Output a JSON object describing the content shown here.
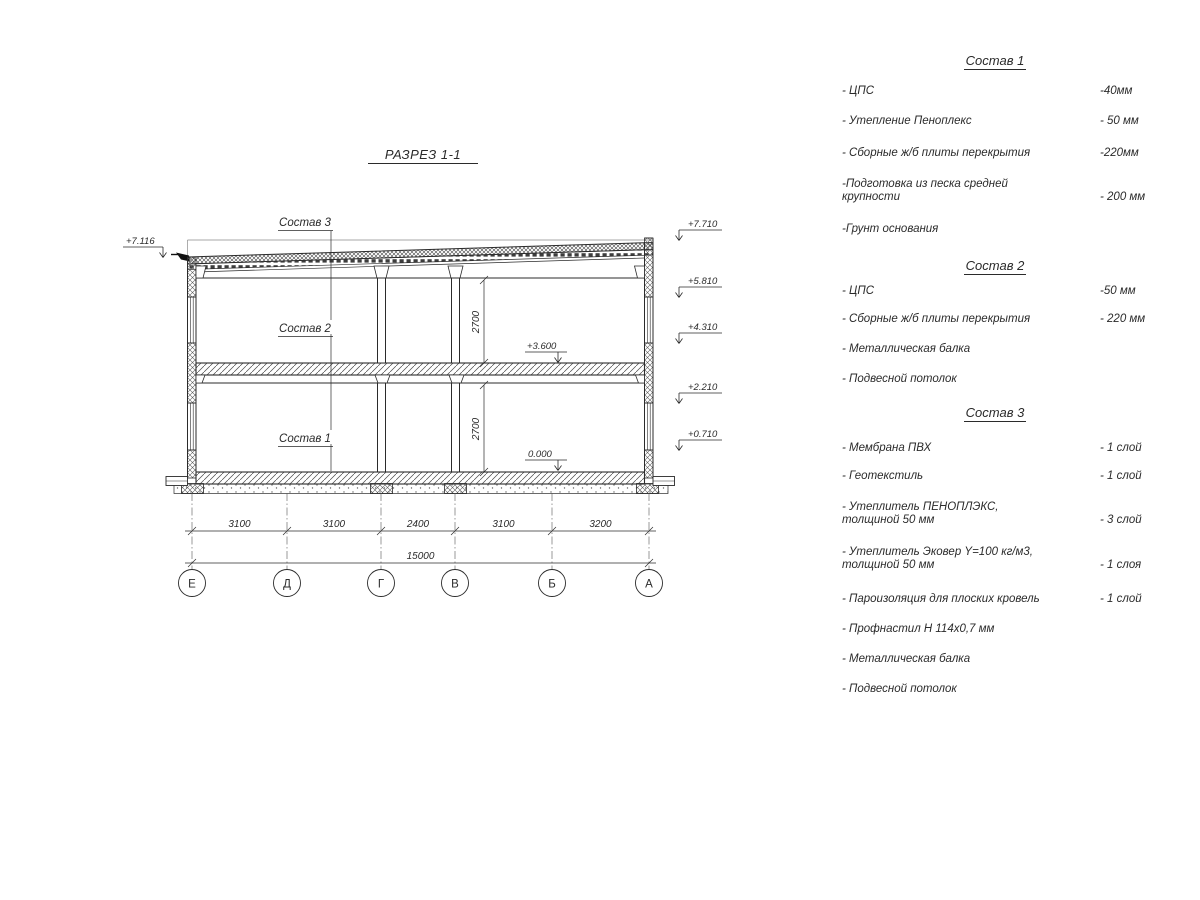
{
  "page": {
    "title": "РАЗРЕЗ 1-1"
  },
  "section_labels": {
    "s3": "Состав 3",
    "s2": "Состав 2",
    "s1": "Состав 1"
  },
  "elevations": {
    "left_top": "+7.116",
    "r1": "+7.710",
    "r2": "+5.810",
    "r3": "+4.310",
    "r4": "+2.210",
    "r5": "+0.710",
    "floor2": "+3.600",
    "floor0": "0.000"
  },
  "dimensions": {
    "d1": "3100",
    "d2": "3100",
    "d3": "2400",
    "d4": "3100",
    "d5": "3200",
    "total": "15000",
    "h_upper": "2700",
    "h_lower": "2700"
  },
  "axes": {
    "a1": "Е",
    "a2": "Д",
    "a3": "Г",
    "a4": "В",
    "a5": "Б",
    "a6": "А"
  },
  "panel": {
    "sections": [
      {
        "heading": "Состав 1",
        "items": [
          {
            "name": "- ЦПС",
            "value": "-40мм"
          },
          {
            "name": "- Утепление Пеноплекс",
            "value": "- 50 мм"
          },
          {
            "name": "- Сборные ж/б плиты перекрытия",
            "value": "-220мм"
          },
          {
            "name": "-Подготовка из песка средней\nкрупности",
            "value": "- 200 мм"
          },
          {
            "name": "-Грунт основания",
            "value": ""
          }
        ]
      },
      {
        "heading": "Состав 2",
        "items": [
          {
            "name": "- ЦПС",
            "value": "-50 мм"
          },
          {
            "name": "- Сборные ж/б плиты перекрытия",
            "value": "- 220 мм"
          },
          {
            "name": "- Металлическая балка",
            "value": ""
          },
          {
            "name": "- Подвесной потолок",
            "value": ""
          }
        ]
      },
      {
        "heading": "Состав 3",
        "items": [
          {
            "name": "- Мембрана ПВХ",
            "value": "- 1 слой"
          },
          {
            "name": "- Геотекстиль",
            "value": "- 1 слой"
          },
          {
            "name": "- Утеплитель ПЕНОПЛЭКС,\nтолщиной 50 мм",
            "value": "- 3 слой"
          },
          {
            "name": "- Утеплитель Эковер Y=100 кг/м3,\nтолщиной 50 мм",
            "value": "- 1 слоя"
          },
          {
            "name": "- Пароизоляция для плоских кровель",
            "value": "- 1 слой"
          },
          {
            "name": "- Профнастил Н 114х0,7 мм",
            "value": ""
          },
          {
            "name": "- Металлическая балка",
            "value": ""
          },
          {
            "name": "- Подвесной потолок",
            "value": ""
          }
        ]
      }
    ]
  },
  "colors": {
    "line": "#2b2b2b",
    "hatch": "#555555"
  }
}
